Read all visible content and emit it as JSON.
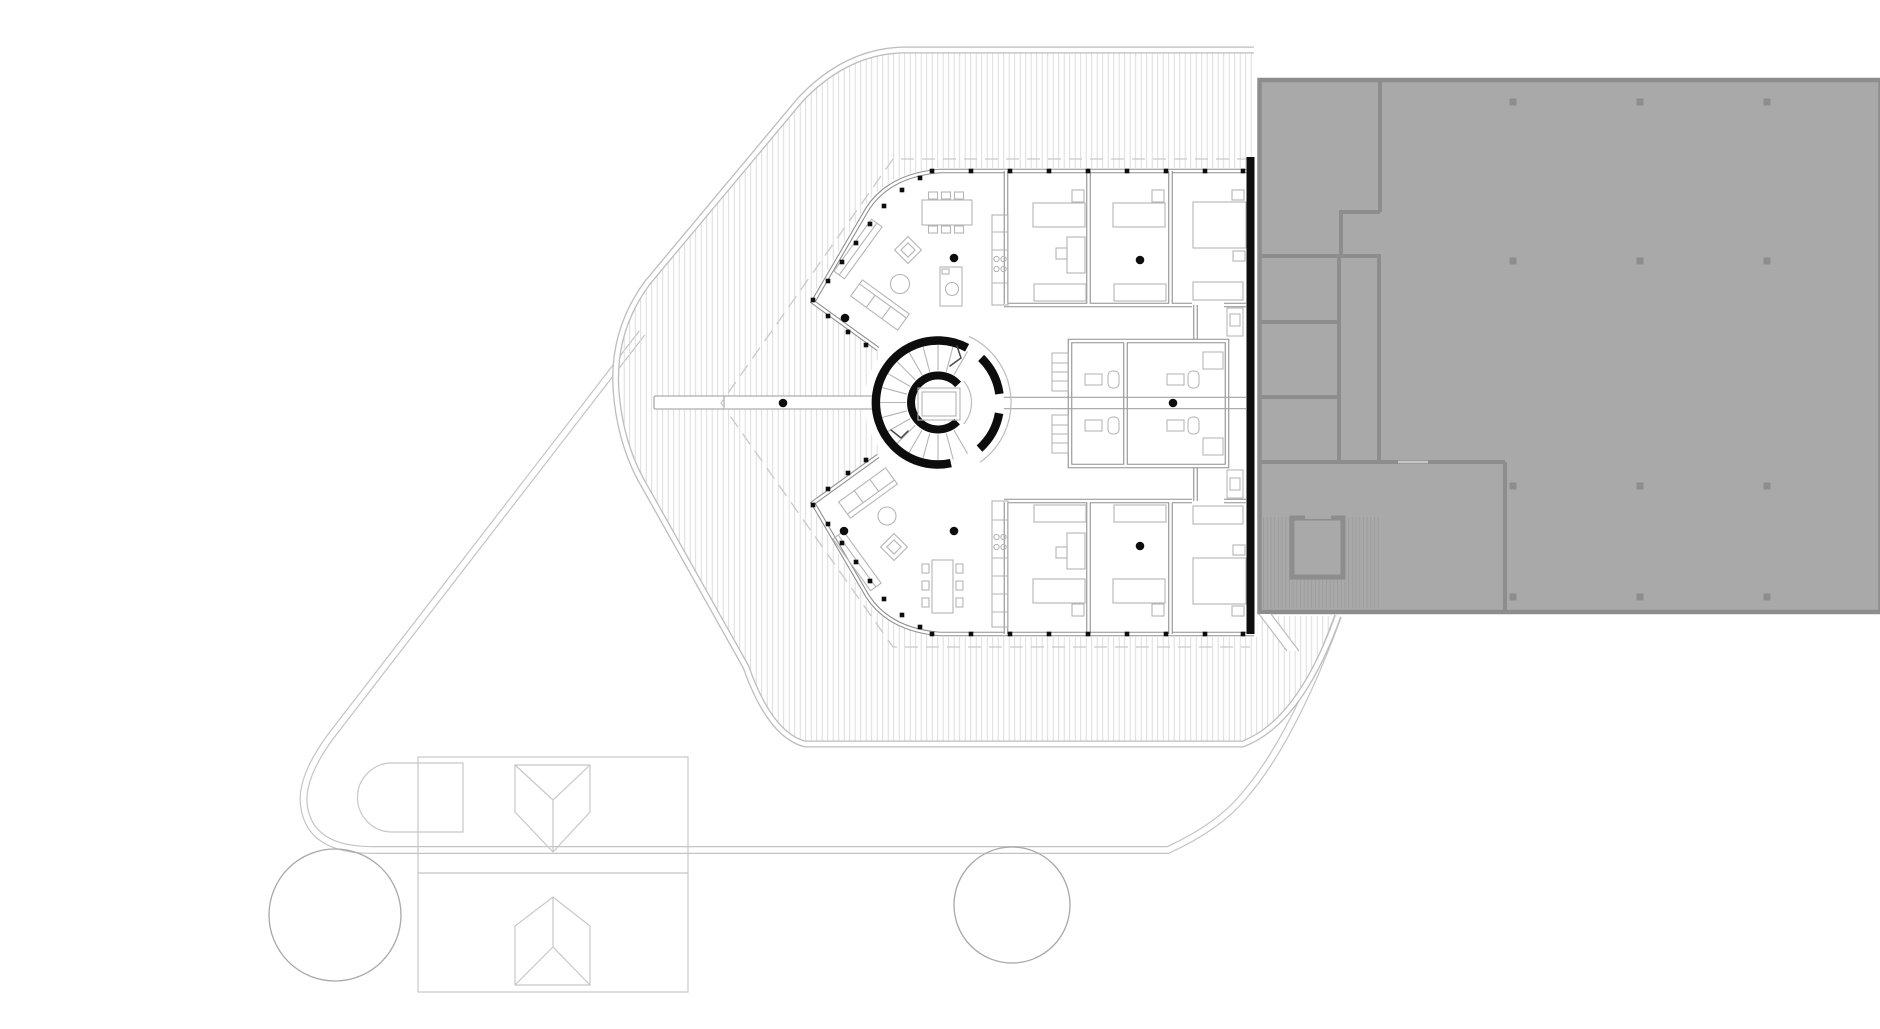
{
  "meta": {
    "drawing_type": "architectural floor plan",
    "view": "top-down plan, black and white line drawing",
    "contents": [
      "pentagonal residential building with central spiral stair",
      "hatched roof terrace decking",
      "adjacent building shown as grey mass",
      "site path",
      "outbuilding with two roof prisms",
      "two trees"
    ]
  },
  "palette": {
    "background": "#ffffff",
    "hatch_line": "#d8d8d8",
    "terrace_edge": "#bdbdbd",
    "dash_line": "#c9c9c9",
    "site_path": "#c4c4c4",
    "wall": "#8f8f8f",
    "thin_line": "#a3a3a3",
    "furniture": "#b5b5b5",
    "fixture": "#b0b0b0",
    "black": "#0d0d0d",
    "adjacent_fill": "#a9a9a9",
    "adjacent_wall": "#8d8d8d",
    "adjacent_hatch": "#9b9b9b",
    "tree": "#a8a8a8",
    "outbuilding": "#c8c8c8"
  },
  "main_building": {
    "rooms": [
      "living-dining north",
      "living-dining south",
      "bedroom x3 north wing",
      "bedroom x3 south wing",
      "bathroom x4 core",
      "spiral stair"
    ],
    "stair": {
      "cx": 938,
      "cy": 402.5,
      "fan": {
        "start_deg": 60,
        "end_deg": 300,
        "step_deg": 15,
        "r_inner": 32,
        "r_outer": 59
      }
    },
    "columns": [
      [
        783,
        403
      ],
      [
        845,
        318
      ],
      [
        954,
        258
      ],
      [
        844,
        531
      ],
      [
        954,
        531
      ],
      [
        1140,
        260
      ],
      [
        1140,
        546
      ],
      [
        1173,
        403
      ]
    ],
    "window_ticks": {
      "size": 4.6,
      "top_y": 171,
      "bottom_y": 634,
      "x": [
        932,
        971,
        1010,
        1049,
        1088,
        1127,
        1166,
        1205,
        1243
      ],
      "diagonal": [
        [
          920,
          178
        ],
        [
          902,
          190
        ],
        [
          884,
          206
        ],
        [
          870,
          224
        ],
        [
          856,
          243
        ],
        [
          842,
          262
        ],
        [
          828,
          281
        ],
        [
          813,
          300
        ],
        [
          828,
          316
        ],
        [
          848,
          332
        ],
        [
          866,
          345
        ],
        [
          920,
          627
        ],
        [
          902,
          615
        ],
        [
          884,
          599
        ],
        [
          870,
          581
        ],
        [
          856,
          562
        ],
        [
          842,
          543
        ],
        [
          828,
          524
        ],
        [
          813,
          505
        ],
        [
          828,
          489
        ],
        [
          848,
          473
        ],
        [
          866,
          460
        ]
      ]
    }
  },
  "adjacent_building": {
    "description": "neighbouring block rendered as solid grey poché with service rooms and a dog-leg stair at lower left",
    "column_grid": {
      "x": [
        1513,
        1640,
        1767
      ],
      "y": [
        102,
        261,
        486,
        597
      ],
      "size": 7
    }
  },
  "site": {
    "trees": [
      {
        "cx": 335,
        "cy": 915,
        "r": 66
      },
      {
        "cx": 1012,
        "cy": 905,
        "r": 58
      }
    ],
    "outbuilding": {
      "bays": 2,
      "roof_prisms": 2
    }
  }
}
